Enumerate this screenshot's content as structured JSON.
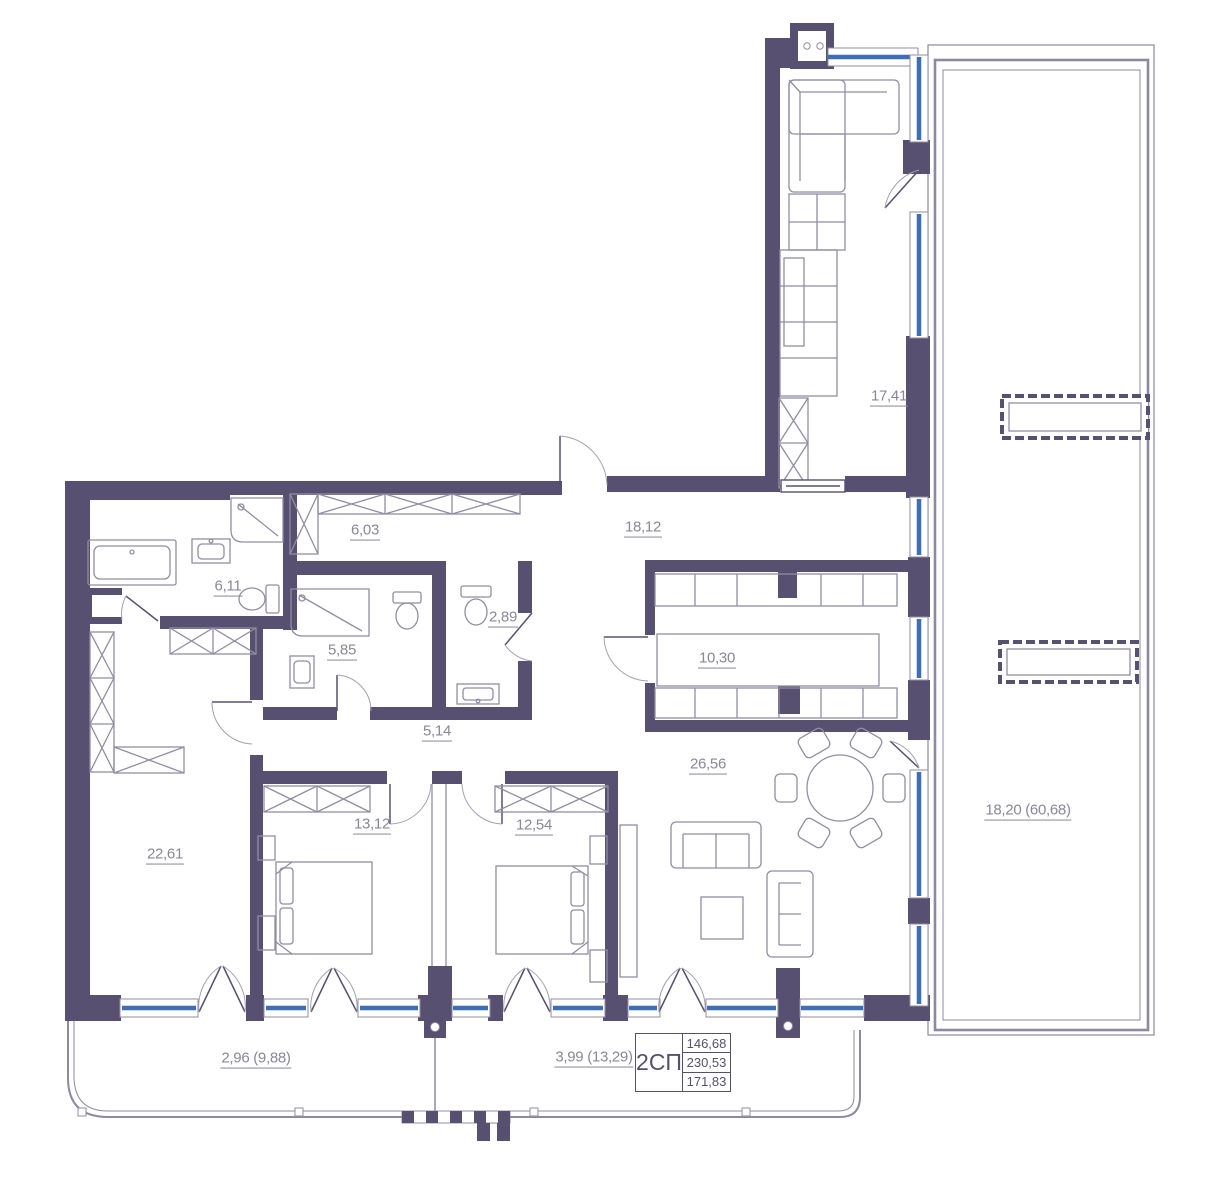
{
  "plan": {
    "title_block": {
      "unit_type": "2СП",
      "values": [
        "146,68",
        "230,53",
        "171,83"
      ]
    },
    "rooms": [
      {
        "id": "kitchen-living",
        "area": "17,41"
      },
      {
        "id": "corridor",
        "area": "18,12"
      },
      {
        "id": "hall-wardrobe",
        "area": "6,03"
      },
      {
        "id": "bathroom",
        "area": "6,11"
      },
      {
        "id": "shower-room",
        "area": "5,85"
      },
      {
        "id": "wc",
        "area": "2,89"
      },
      {
        "id": "hallway",
        "area": "5,14"
      },
      {
        "id": "walk-in-closet",
        "area": "10,30"
      },
      {
        "id": "living-room",
        "area": "26,56"
      },
      {
        "id": "bedroom-master",
        "area": "22,61"
      },
      {
        "id": "bedroom-2",
        "area": "13,12"
      },
      {
        "id": "bedroom-3",
        "area": "12,54"
      },
      {
        "id": "terrace",
        "area": "18,20 (60,68)"
      },
      {
        "id": "balcony-left",
        "area": "2,96 (9,88)"
      },
      {
        "id": "balcony-right",
        "area": "3,99 (13,29)"
      }
    ],
    "colors": {
      "wall": "#575070",
      "glazing": "#3d6fb5",
      "furniture": "#918da3",
      "label": "#8b8699"
    }
  }
}
